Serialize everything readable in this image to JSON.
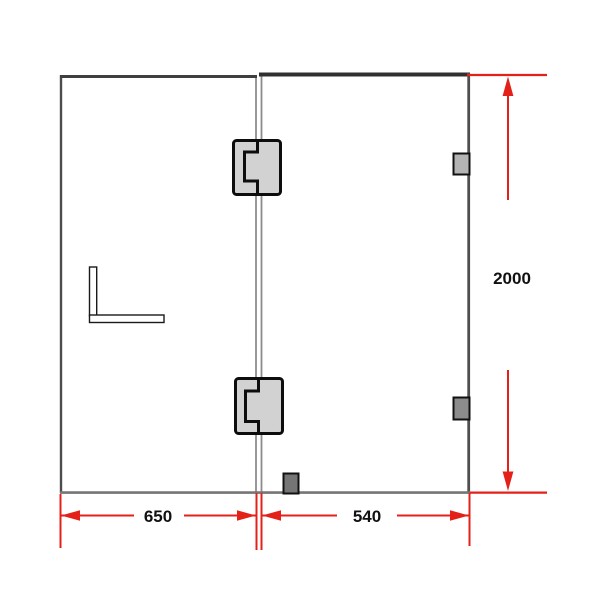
{
  "diagram": {
    "dimensions": {
      "left_panel_width": "650",
      "right_panel_width": "540",
      "panel_height": "2000"
    },
    "colors": {
      "background": "#ffffff",
      "dimension_red": "#e32119",
      "top_edge_dark": "#333333",
      "side_edge_gray": "#4d4d4d",
      "bottom_edge_gray": "#757575",
      "divider_gray": "#8c8c8c",
      "hinge_fill": "#d2d2d2",
      "hinge_outline": "#0d0d0d",
      "wall_bracket_top_fill": "#b4b4b4",
      "wall_bracket_bottom_fill": "#8c8c8c",
      "floor_bracket_fill": "#757575",
      "l_bracket_fill": "#ffffff"
    }
  }
}
